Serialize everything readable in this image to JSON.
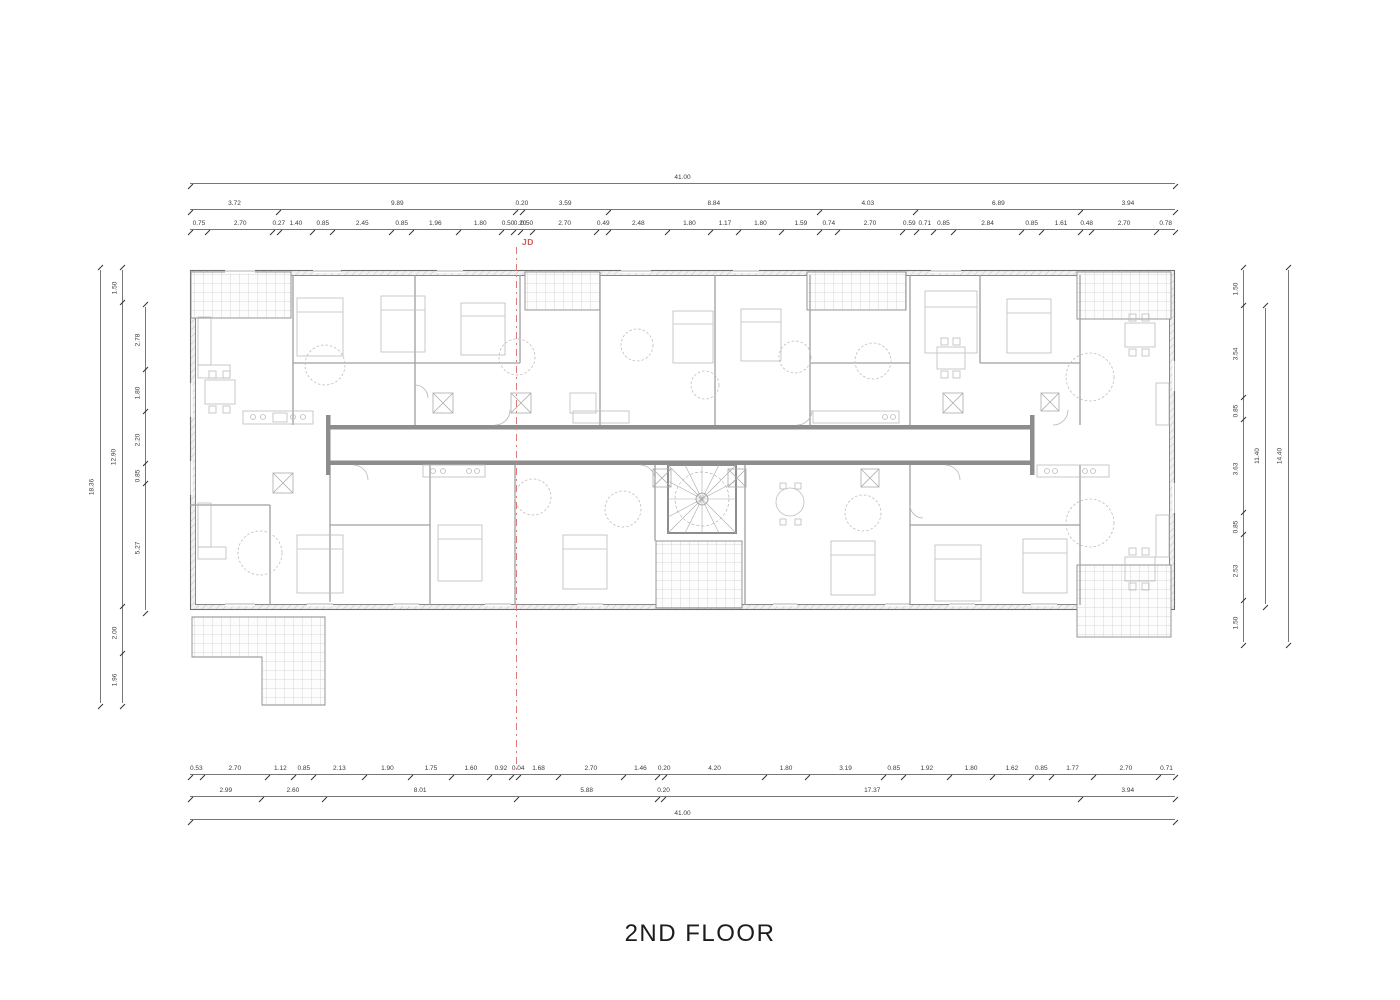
{
  "title": "2ND FLOOR",
  "marker_label": "JD",
  "colors": {
    "marker_red": "#cc5b5b",
    "wall_gray": "#8d8d8d",
    "dim_line": "#777777"
  },
  "dimensions": {
    "top": {
      "overall": [
        "41.00"
      ],
      "segments": [
        "3.72",
        "9.89",
        "0.20",
        "3.59",
        "8.84",
        "4.03",
        "6.89",
        "3.94"
      ],
      "detail": [
        "0.75",
        "2.70",
        "0.27",
        "1.40",
        "0.85",
        "2.45",
        "0.85",
        "1.96",
        "1.80",
        "0.50",
        "0.20",
        "0.50",
        "2.70",
        "0.49",
        "2.48",
        "1.80",
        "1.17",
        "1.80",
        "1.59",
        "0.74",
        "2.70",
        "0.59",
        "0.71",
        "0.85",
        "2.84",
        "0.85",
        "1.61",
        "0.48",
        "2.70",
        "0.78"
      ]
    },
    "bottom": {
      "detail": [
        "0.53",
        "2.70",
        "1.12",
        "0.85",
        "2.13",
        "1.90",
        "1.75",
        "1.60",
        "0.92",
        "0.04",
        "1.68",
        "2.70",
        "1.46",
        "0.20",
        "4.20",
        "1.80",
        "3.19",
        "0.85",
        "1.92",
        "1.80",
        "1.62",
        "0.85",
        "1.77",
        "2.70",
        "0.71"
      ],
      "segments": [
        "2.99",
        "2.60",
        "8.01",
        "5.88",
        "0.20",
        "17.37",
        "3.94"
      ],
      "overall": [
        "41.00"
      ]
    },
    "left": {
      "overall": [
        "18.36"
      ],
      "outer": [
        "1.50",
        "12.90",
        "2.00",
        "1.96"
      ],
      "inner": [
        "2.78",
        "1.80",
        "2.20",
        "0.85",
        "5.27"
      ]
    },
    "right": {
      "detail": [
        "1.50",
        "3.54",
        "0.85",
        "3.63",
        "0.85",
        "2.53",
        "1.50"
      ],
      "mid": [
        "11.40"
      ],
      "overall": [
        "14.40"
      ]
    }
  }
}
